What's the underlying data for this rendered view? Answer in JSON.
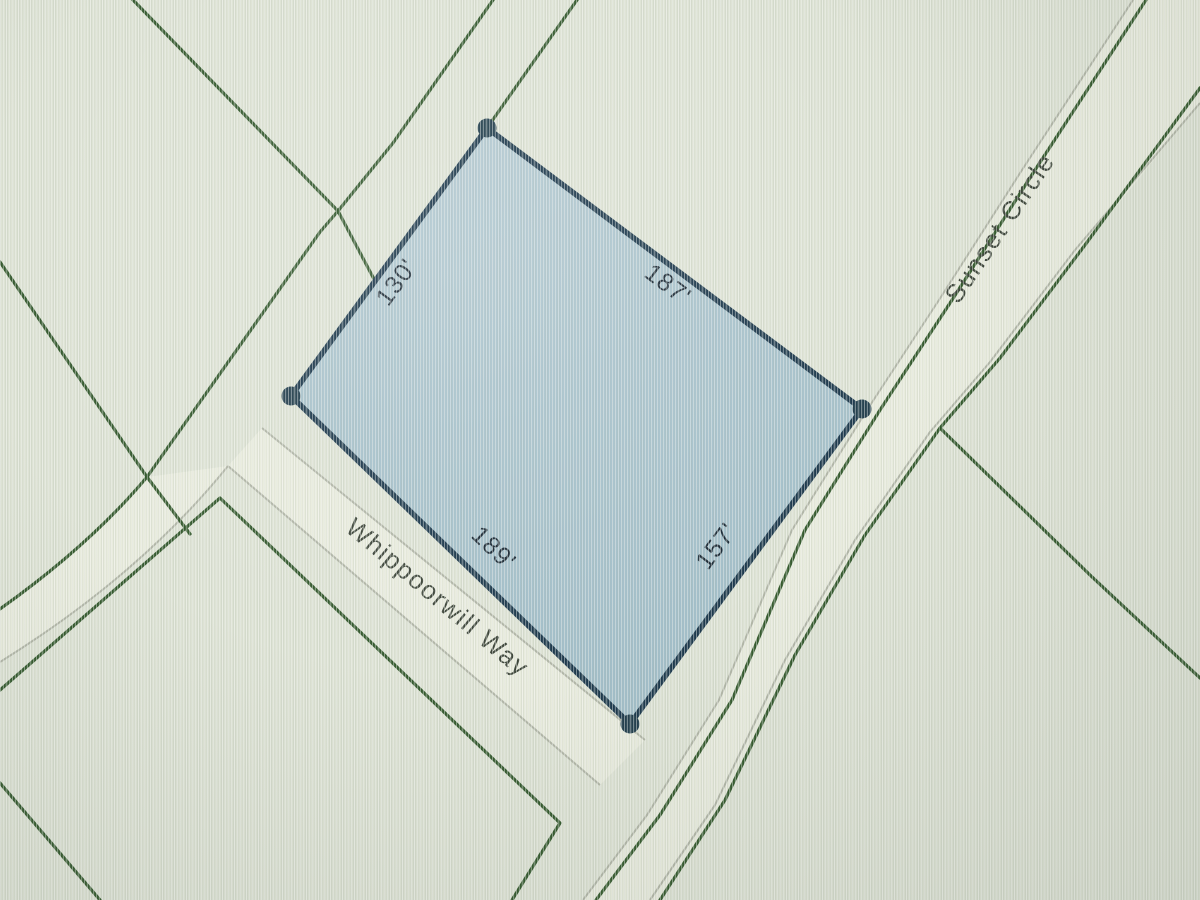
{
  "map": {
    "parcel": {
      "edge_labels": {
        "nw": "130'",
        "ne": "187'",
        "sw": "189'",
        "se": "157'"
      },
      "fill_color": "#a9c3cd",
      "border_color": "#1e3a4e"
    },
    "streets": [
      {
        "name": "Sunset Circle"
      },
      {
        "name": "Whippoorwill Way"
      }
    ],
    "colors": {
      "background": "#dee3d5",
      "lot_line_green": "#2e5428",
      "road_edge_gray": "#b2b6a8",
      "road_fill": "#e9ecde",
      "vertex_dot": "#24404f",
      "dimension_text": "#1c2a36",
      "street_text": "#3e463b"
    }
  }
}
